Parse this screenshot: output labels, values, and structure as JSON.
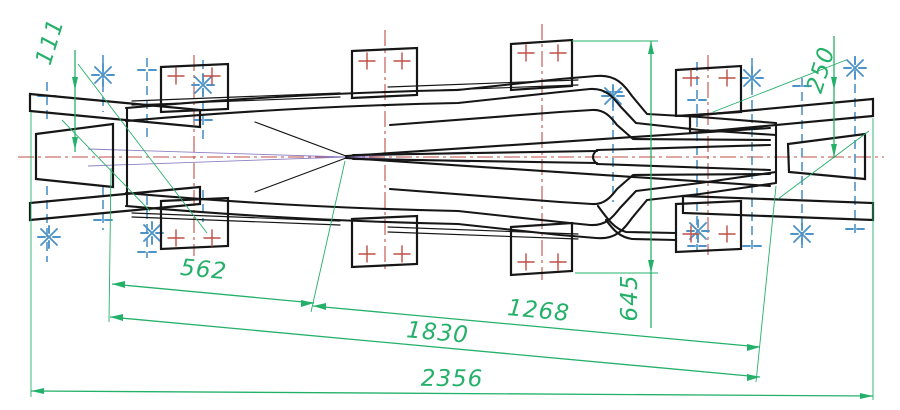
{
  "drawing": {
    "dimensions": {
      "d111": "111",
      "d250": "250",
      "d562": "562",
      "d645": "645",
      "d1268": "1268",
      "d1830": "1830",
      "d2356": "2356"
    },
    "marks": {
      "bolt_mark": "asterisk-mark",
      "hole_mark": "plus-mark"
    }
  },
  "colors": {
    "background": "#ffffff",
    "outline": "#161616",
    "dimension": "#25b06a",
    "centerline": "#bf4e45",
    "bolt_line": "#4e93c7",
    "construction": "#8f7fc4"
  }
}
